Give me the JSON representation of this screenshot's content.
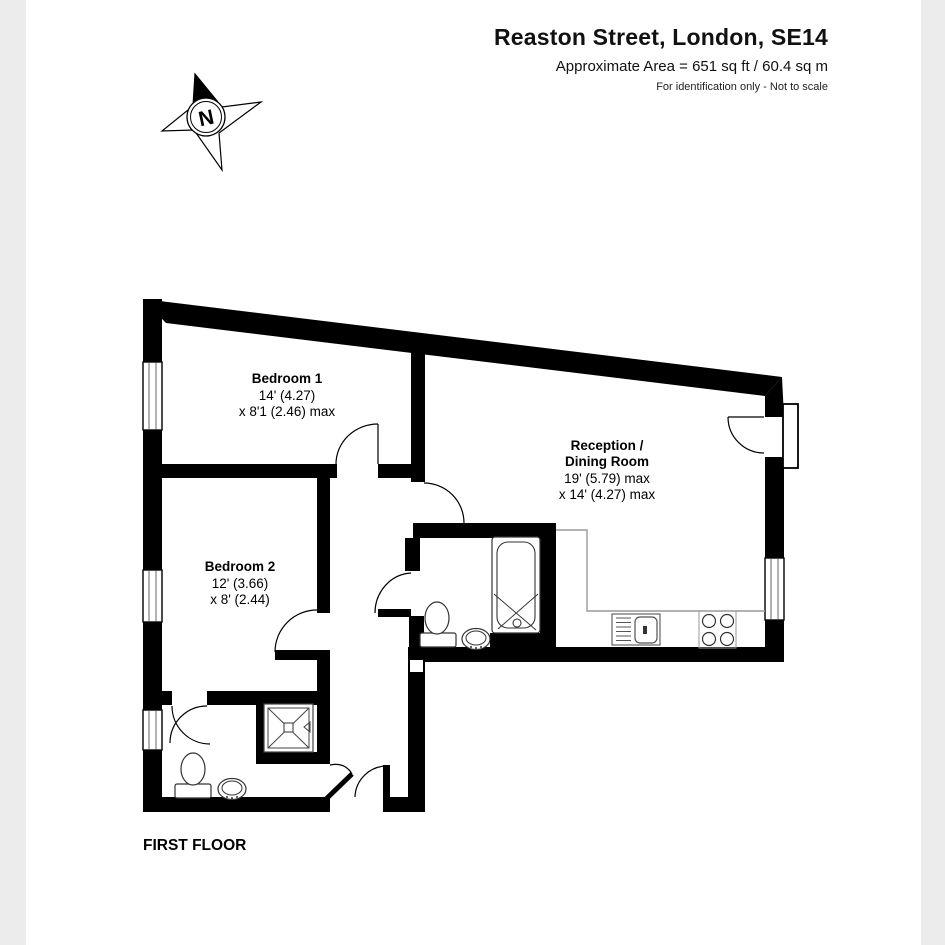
{
  "page": {
    "background": "#ffffff",
    "side_band_color": "#ececec"
  },
  "header": {
    "title": "Reaston Street, London, SE14",
    "subtitle": "Approximate Area = 651 sq ft / 60.4 sq m",
    "disclaimer": "For identification only - Not to scale"
  },
  "compass": {
    "label": "N"
  },
  "plan": {
    "floor_label": "FIRST FLOOR",
    "rooms": [
      {
        "id": "bedroom-1",
        "lines": [
          "Bedroom 1",
          "14' (4.27)",
          "x 8'1 (2.46) max"
        ]
      },
      {
        "id": "reception-dining",
        "lines": [
          "Reception /",
          "Dining Room",
          "19' (5.79) max",
          "x 14' (4.27) max"
        ]
      },
      {
        "id": "bedroom-2",
        "lines": [
          "Bedroom 2",
          "12' (3.66)",
          "x 8' (2.44)"
        ]
      }
    ],
    "symbols": [
      "compass-north",
      "bathtub",
      "toilet",
      "basin",
      "shower-tray",
      "kitchen-sink",
      "hob",
      "window",
      "door-swing"
    ],
    "colors": {
      "wall": "#000000",
      "counter_line": "#a0a0a0"
    }
  }
}
